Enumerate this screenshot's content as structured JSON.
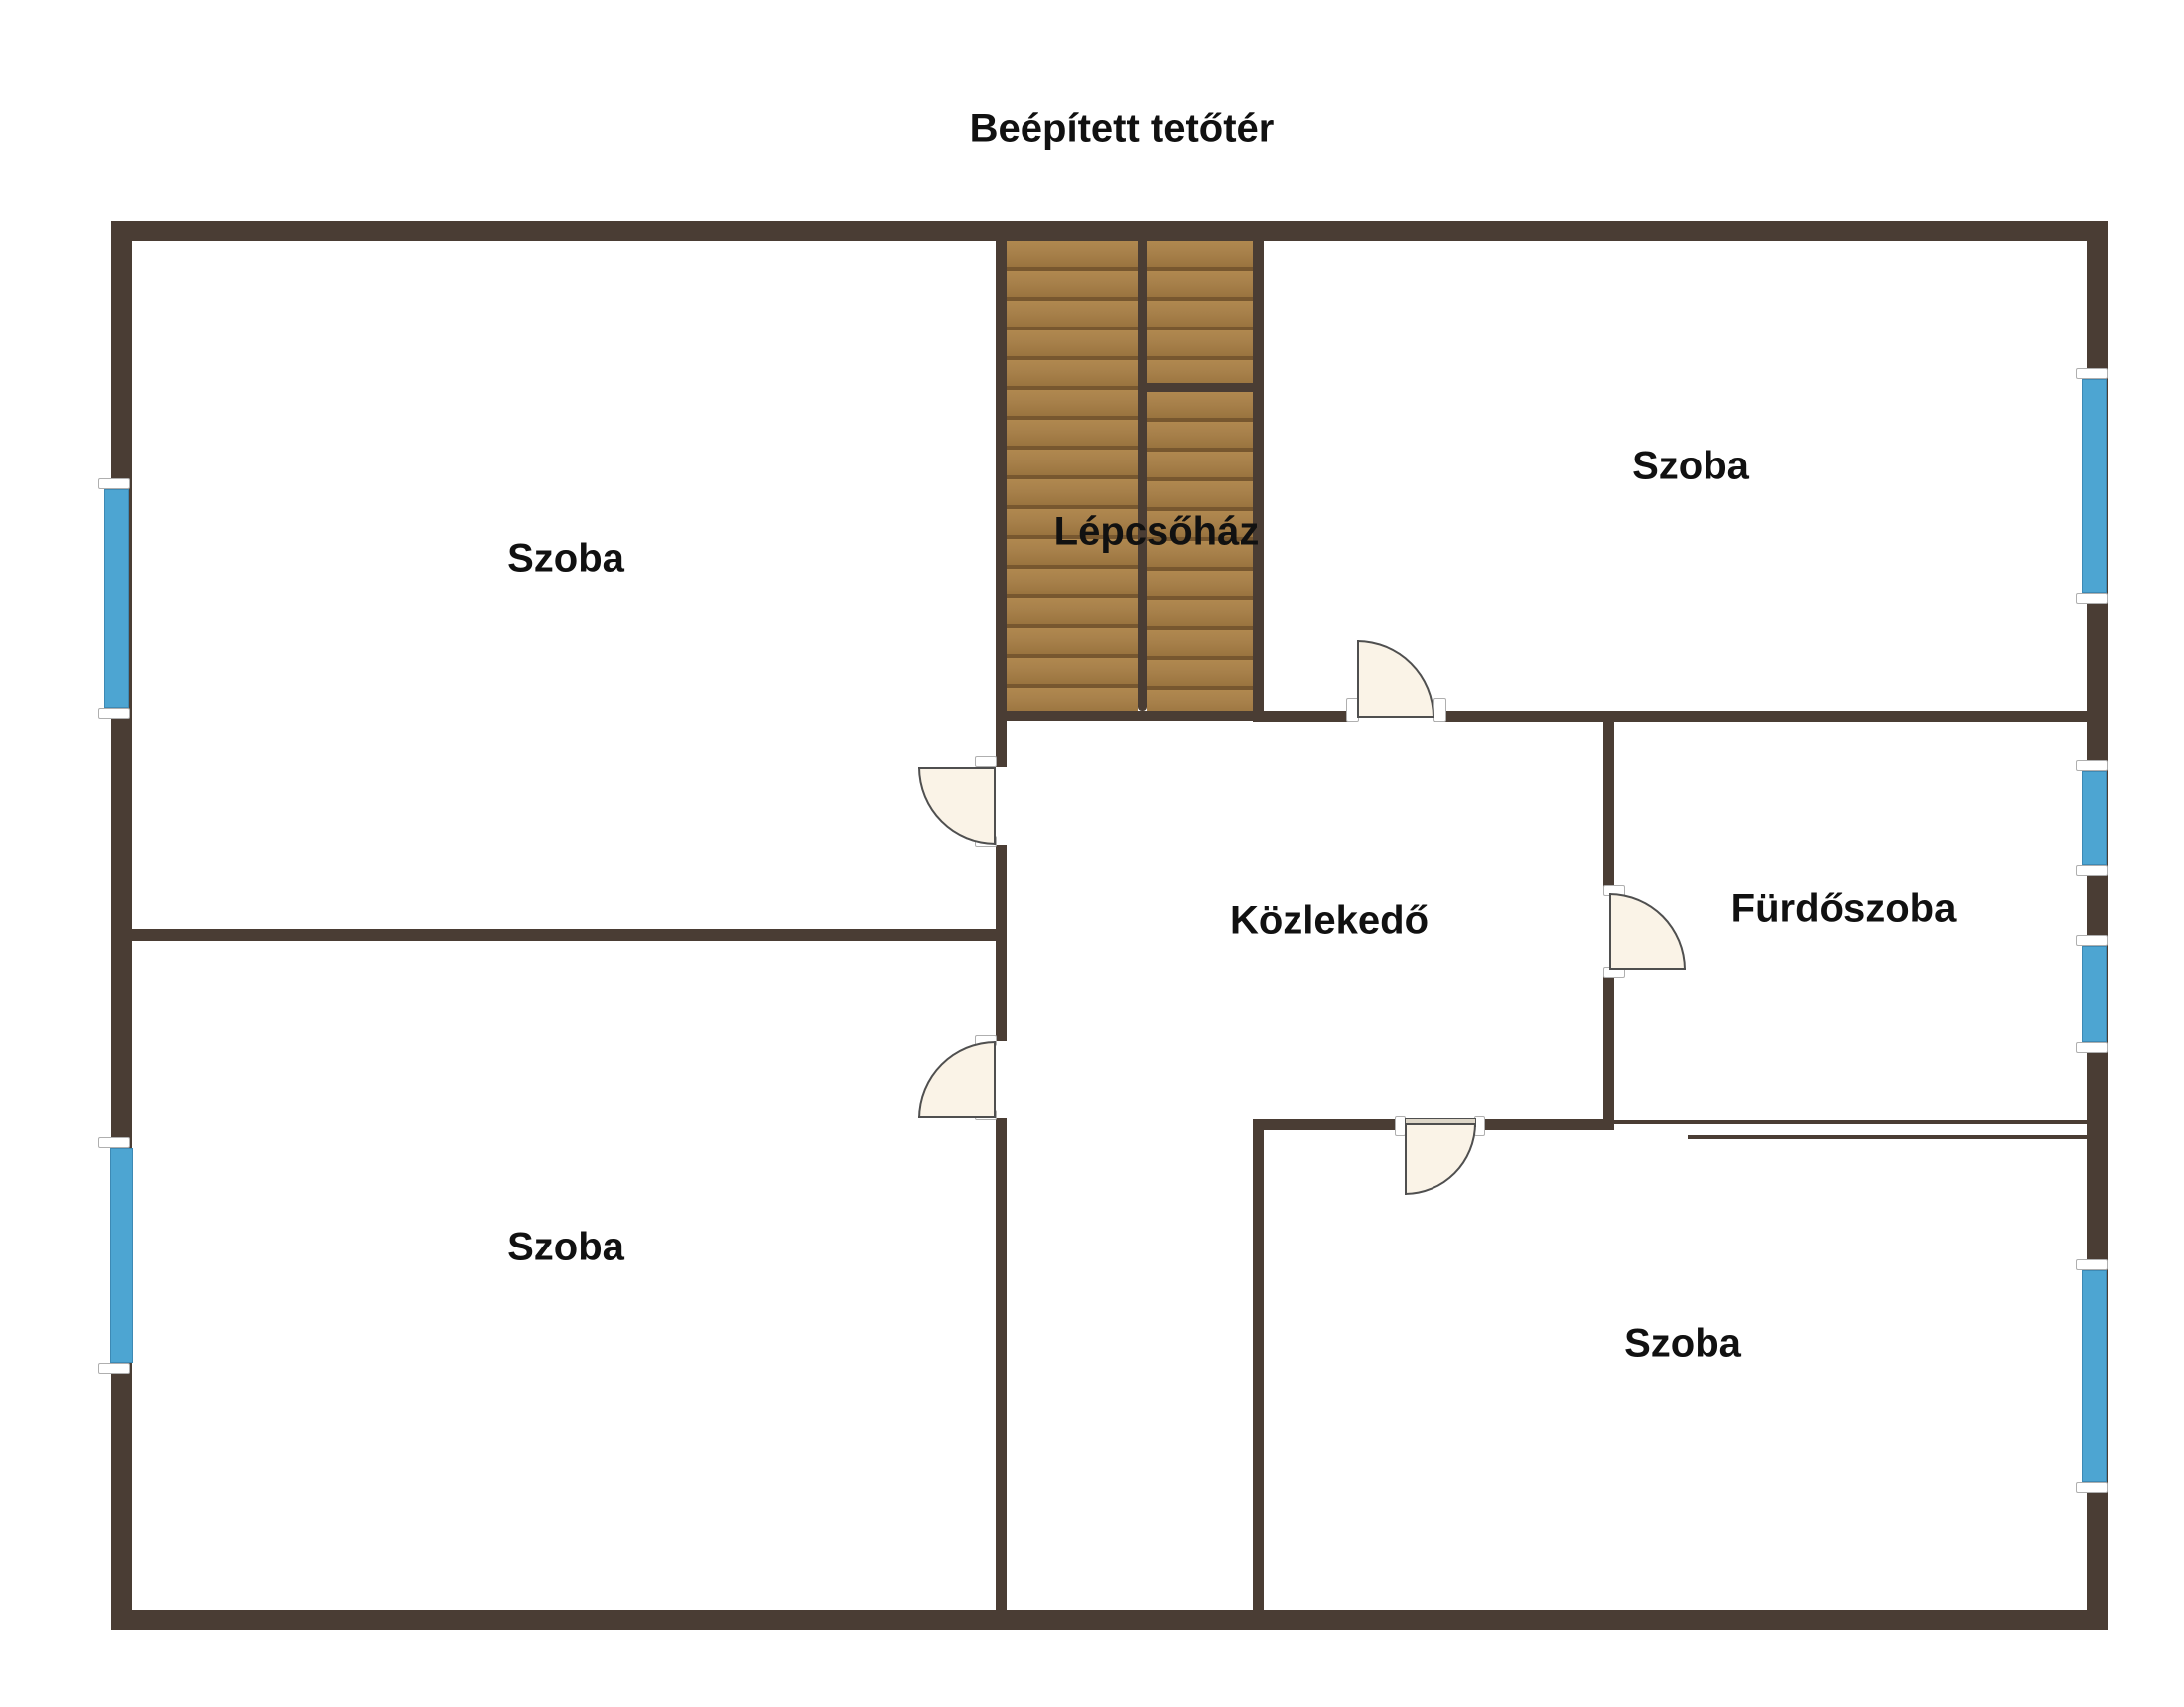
{
  "title": "Beépített tetőtér",
  "rooms": {
    "room_top_left": {
      "label": "Szoba"
    },
    "room_top_right": {
      "label": "Szoba"
    },
    "staircase": {
      "label": "Lépcsőház"
    },
    "hallway": {
      "label": "Közlekedő"
    },
    "bathroom": {
      "label": "Fürdőszoba"
    },
    "room_bottom_left": {
      "label": "Szoba"
    },
    "room_bottom_right": {
      "label": "Szoba"
    }
  },
  "colors": {
    "wall": "#4A3D34",
    "wood": "#A8814B",
    "wood_line": "#77572F",
    "window": "#4DA5D2",
    "door_fill": "#FAF3E7",
    "door_outline": "#4F4F4F",
    "label": "#111111",
    "background": "#FFFFFF"
  }
}
